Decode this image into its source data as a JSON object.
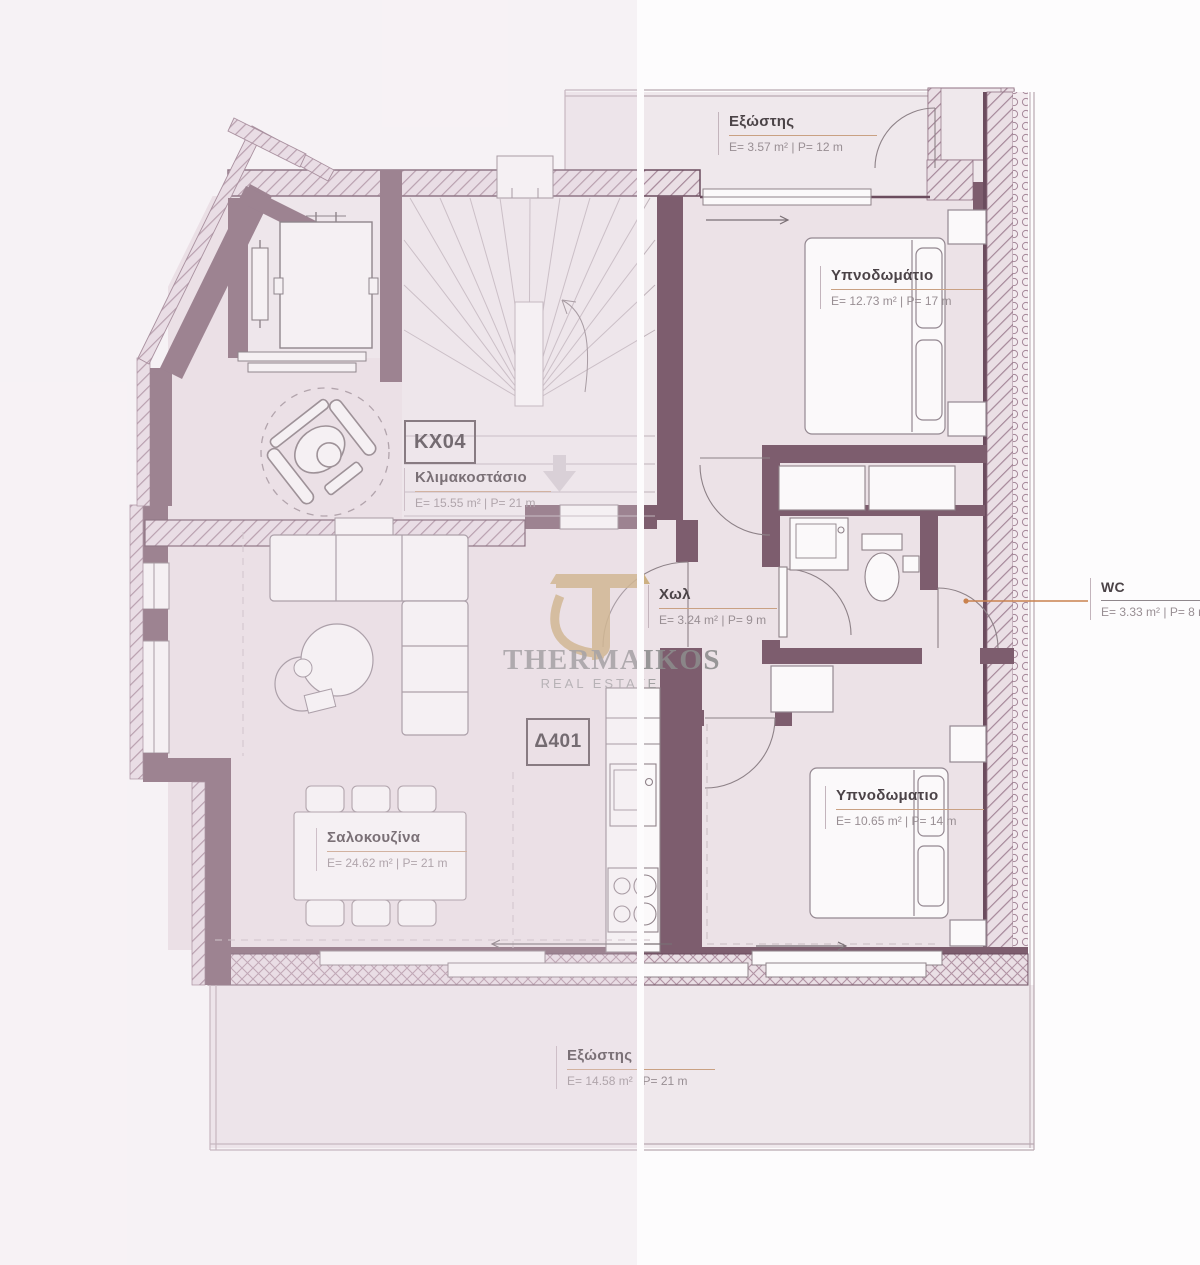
{
  "branding": {
    "name": "THERMAIKOS",
    "tagline": "REAL ESTATE"
  },
  "unit_tags": {
    "stairwell_code": "KX04",
    "apartment_code": "Δ401"
  },
  "rooms": {
    "balcony_top": {
      "name": "Εξώστης",
      "dims": "E= 3.57 m² | P= 12 m"
    },
    "bedroom_top": {
      "name": "Υπνοδωμάτιο",
      "dims": "E= 12.73 m² | P= 17 m"
    },
    "stairwell": {
      "name": "Κλιμακοστάσιο",
      "dims": "E= 15.55 m² | P= 21 m"
    },
    "hall": {
      "name": "Χωλ",
      "dims": "E= 3.24 m² | P= 9 m"
    },
    "wc": {
      "name": "WC",
      "dims": "E= 3.33 m² | P= 8 m"
    },
    "living": {
      "name": "Σαλοκουζίνα",
      "dims": "E= 24.62 m² | P= 21 m"
    },
    "bedroom_bottom": {
      "name": "Υπνοδωματιο",
      "dims": "E= 10.65 m² | P= 14 m"
    },
    "balcony_bottom": {
      "name": "Εξώστης",
      "dims": "E= 14.58 m² | P= 21 m"
    }
  },
  "colors": {
    "wall": "#7d5d6e",
    "hatch_line": "#a58799",
    "hatch_bg": "#eadfe5",
    "floor": "#ece2e7",
    "floor_light": "#f1ebee",
    "balcony": "#efe8ec",
    "accent_underline": "#c9a183",
    "leader": "#c9824e",
    "title_text": "#4b4347",
    "dims_text": "#988e93",
    "logo_gold": "#c7a76e",
    "logo_gray": "#8c8c8c"
  }
}
